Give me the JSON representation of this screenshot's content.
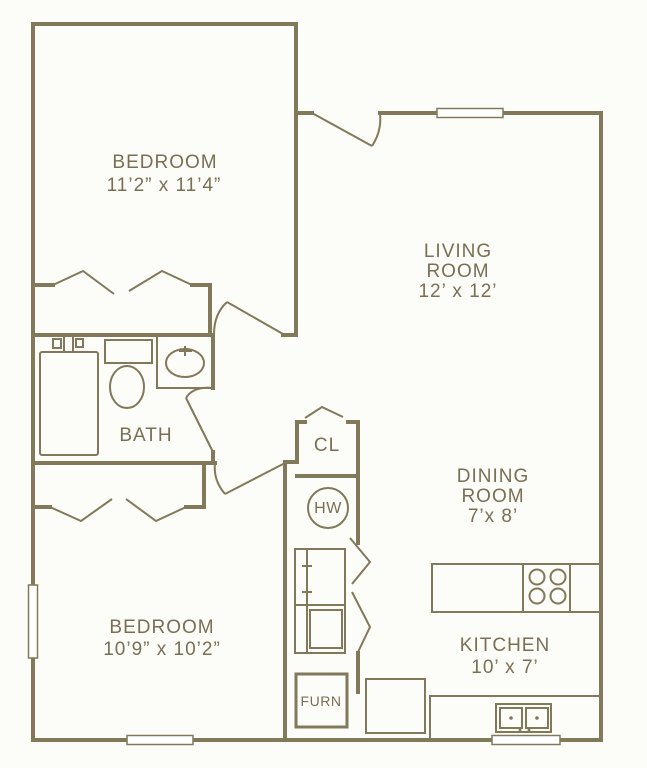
{
  "colors": {
    "wall": "#82785a",
    "text": "#796f54",
    "background": "#fcfcf8"
  },
  "rooms": {
    "bedroom1": {
      "label": "BEDROOM",
      "dims": "11’2” x 11’4”"
    },
    "living": {
      "label_line1": "LIVING",
      "label_line2": "ROOM",
      "dims": "12’ x 12’"
    },
    "bath": {
      "label": "BATH"
    },
    "hall_closet": {
      "label": "CL"
    },
    "water_heater": {
      "label": "HW"
    },
    "dining": {
      "label_line1": "DINING",
      "label_line2": "ROOM",
      "dims": "7’x 8’"
    },
    "bedroom2": {
      "label": "BEDROOM",
      "dims": "10’9” x 10’2”"
    },
    "kitchen": {
      "label": "KITCHEN",
      "dims": "10’ x 7’"
    },
    "furnace": {
      "label": "FURN"
    }
  }
}
